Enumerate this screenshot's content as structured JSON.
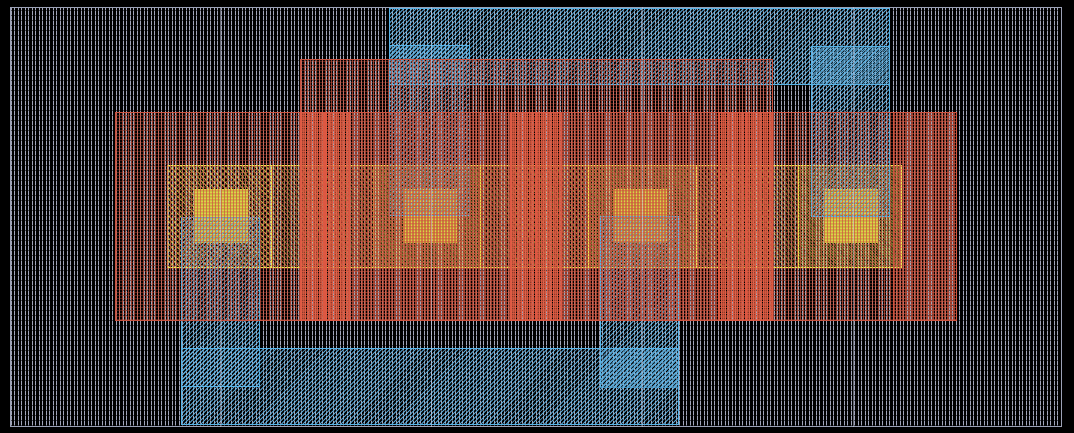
{
  "app": {
    "type": "ic-layout-viewer",
    "description": "Integrated-circuit layout canvas with hatched layer rectangles (4-finger device)"
  },
  "canvas": {
    "width": 1074,
    "height": 433,
    "background": "#000000"
  },
  "viewport": {
    "x": 10,
    "y": 7,
    "width": 1052,
    "height": 420,
    "border_color": "#9ca2b6"
  },
  "grid": {
    "vertical_lines_x": [
      220,
      431,
      642,
      853
    ],
    "color": "rgba(200,206,230,0.5)"
  },
  "layers": {
    "gray": {
      "label": "substrate-well-hatch",
      "color": "#a2a6ba",
      "pattern": "vertical-wiggle-hatch"
    },
    "blue": {
      "label": "metal1",
      "color": "#5cb6e8",
      "pattern": "diagonal-hatch"
    },
    "red": {
      "label": "poly-implant",
      "color": "#cc5440",
      "pattern": "fine-grid-hatch"
    },
    "red-dense": {
      "label": "poly-contact-column",
      "color": "#e05844",
      "pattern": "dense-grid-hatch"
    },
    "yellow": {
      "label": "local-interconnect",
      "color": "#ece64e",
      "pattern": "diagonal-dot-hatch"
    },
    "contact": {
      "label": "contact-cut",
      "color": "#dcd348",
      "pattern": "solid"
    }
  },
  "rects": [
    {
      "name": "substrate-region",
      "layer": "gray",
      "x": 10,
      "y": 7,
      "w": 1052,
      "h": 420
    },
    {
      "name": "li-band",
      "layer": "yellow",
      "x": 167,
      "y": 165,
      "w": 735,
      "h": 103
    },
    {
      "name": "li-strap-1",
      "layer": "yellow",
      "x": 167,
      "y": 165,
      "w": 105,
      "h": 103
    },
    {
      "name": "li-strap-2",
      "layer": "yellow",
      "x": 373,
      "y": 165,
      "w": 108,
      "h": 103
    },
    {
      "name": "li-strap-3",
      "layer": "yellow",
      "x": 588,
      "y": 165,
      "w": 109,
      "h": 103
    },
    {
      "name": "li-strap-4",
      "layer": "yellow",
      "x": 798,
      "y": 165,
      "w": 104,
      "h": 103
    },
    {
      "name": "contact-1",
      "layer": "contact",
      "x": 194,
      "y": 189,
      "w": 54,
      "h": 54
    },
    {
      "name": "contact-2",
      "layer": "contact",
      "x": 403,
      "y": 189,
      "w": 54,
      "h": 54
    },
    {
      "name": "contact-3",
      "layer": "contact",
      "x": 613,
      "y": 189,
      "w": 54,
      "h": 54
    },
    {
      "name": "contact-4",
      "layer": "contact",
      "x": 824,
      "y": 189,
      "w": 54,
      "h": 54
    },
    {
      "name": "metal-rail-top",
      "layer": "blue",
      "x": 389,
      "y": 8,
      "w": 501,
      "h": 77
    },
    {
      "name": "metal-stub-top-1",
      "layer": "blue",
      "x": 389,
      "y": 45,
      "w": 81,
      "h": 171
    },
    {
      "name": "metal-stub-top-2",
      "layer": "blue",
      "x": 811,
      "y": 46,
      "w": 79,
      "h": 171
    },
    {
      "name": "metal-stub-bottom-1",
      "layer": "blue",
      "x": 181,
      "y": 217,
      "w": 79,
      "h": 170
    },
    {
      "name": "metal-stub-bottom-2",
      "layer": "blue",
      "x": 600,
      "y": 216,
      "w": 79,
      "h": 172
    },
    {
      "name": "metal-rail-bottom",
      "layer": "blue",
      "x": 181,
      "y": 348,
      "w": 498,
      "h": 77
    },
    {
      "name": "poly-region-main",
      "layer": "red",
      "x": 115,
      "y": 112,
      "w": 842,
      "h": 209
    },
    {
      "name": "poly-region-upper",
      "layer": "red",
      "x": 300,
      "y": 59,
      "w": 473,
      "h": 262
    },
    {
      "name": "poly-region-right",
      "layer": "red",
      "x": 893,
      "y": 112,
      "w": 64,
      "h": 209
    },
    {
      "name": "poly-contact-col-1a",
      "layer": "red-dense",
      "x": 300,
      "y": 112,
      "w": 25,
      "h": 209
    },
    {
      "name": "poly-contact-col-1b",
      "layer": "red-dense",
      "x": 325,
      "y": 112,
      "w": 25,
      "h": 209
    },
    {
      "name": "poly-contact-col-2a",
      "layer": "red-dense",
      "x": 510,
      "y": 112,
      "w": 26,
      "h": 209
    },
    {
      "name": "poly-contact-col-2b",
      "layer": "red-dense",
      "x": 536,
      "y": 112,
      "w": 26,
      "h": 209
    },
    {
      "name": "poly-contact-col-3a",
      "layer": "red-dense",
      "x": 718,
      "y": 112,
      "w": 28,
      "h": 209
    },
    {
      "name": "poly-contact-col-3b",
      "layer": "red-dense",
      "x": 746,
      "y": 112,
      "w": 27,
      "h": 209
    }
  ]
}
